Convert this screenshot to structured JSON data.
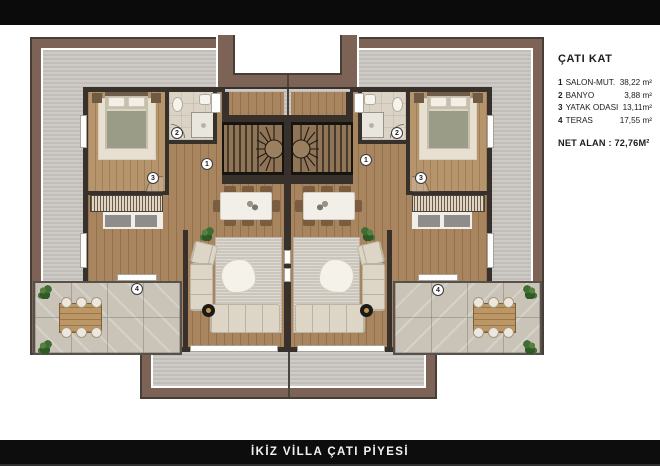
{
  "legend": {
    "title": "ÇATI KAT",
    "items": [
      {
        "num": "1",
        "label": "SALON-MUT.",
        "area": "38,22 m²"
      },
      {
        "num": "2",
        "label": "BANYO",
        "area": "3,88 m²"
      },
      {
        "num": "3",
        "label": "YATAK ODASI",
        "area": "13,11m²"
      },
      {
        "num": "4",
        "label": "TERAS",
        "area": "17,55 m²"
      }
    ],
    "net_area": "NET ALAN : 72,76M²"
  },
  "plan": {
    "markers": {
      "salon": "1",
      "banyo": "2",
      "yatak_odasi": "3",
      "teras": "4"
    },
    "colors": {
      "bar_black": "#0b0b0b",
      "roof_fascia_brown": "#7d6355",
      "roof_surface_gray": "#c8c4bf",
      "wall_dark": "#38302a",
      "wood_floor": "#a8855e",
      "terrace_stone": "#c9c3b8"
    }
  },
  "footer": {
    "title": "İKİZ VİLLA ÇATI PİYESİ"
  }
}
